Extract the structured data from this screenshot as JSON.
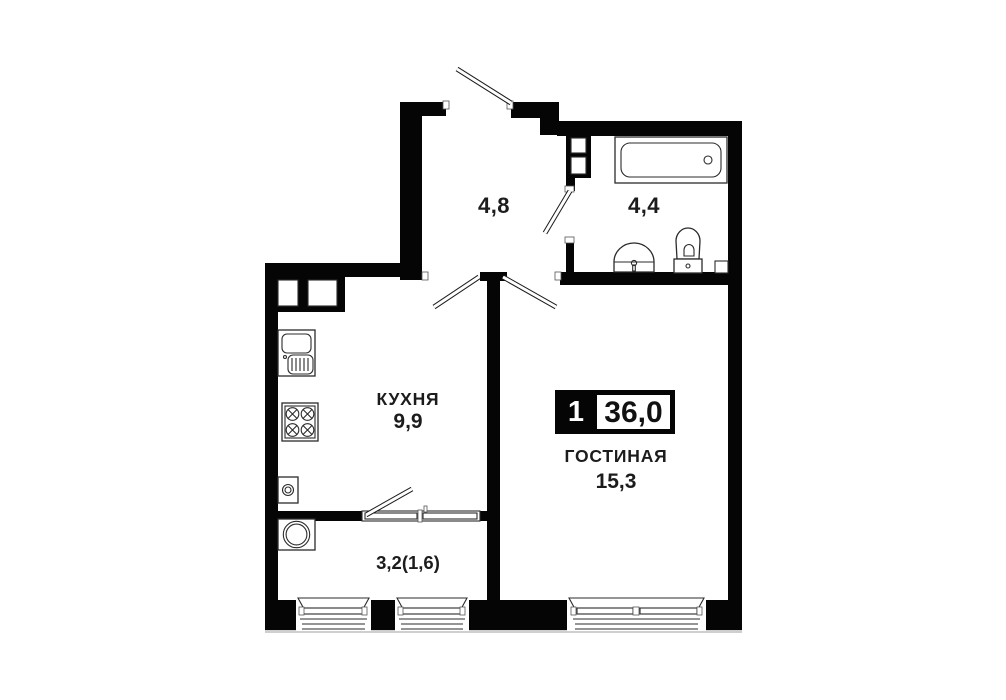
{
  "plan": {
    "hallway": {
      "area": "4,8"
    },
    "bathroom": {
      "area": "4,4"
    },
    "kitchen": {
      "name": "КУХНЯ",
      "area": "9,9"
    },
    "living_room": {
      "name": "ГОСТИНАЯ",
      "area": "15,3"
    },
    "balcony": {
      "area": "3,2(1,6)"
    },
    "badge": {
      "rooms_count": "1",
      "total_area": "36,0"
    }
  },
  "colors": {
    "wall": "#050505",
    "fixture_line": "#2b2b2b",
    "text": "#1c1c1c",
    "badge_background": "#050505",
    "badge_number_text": "#ffffff",
    "background": "#ffffff"
  }
}
